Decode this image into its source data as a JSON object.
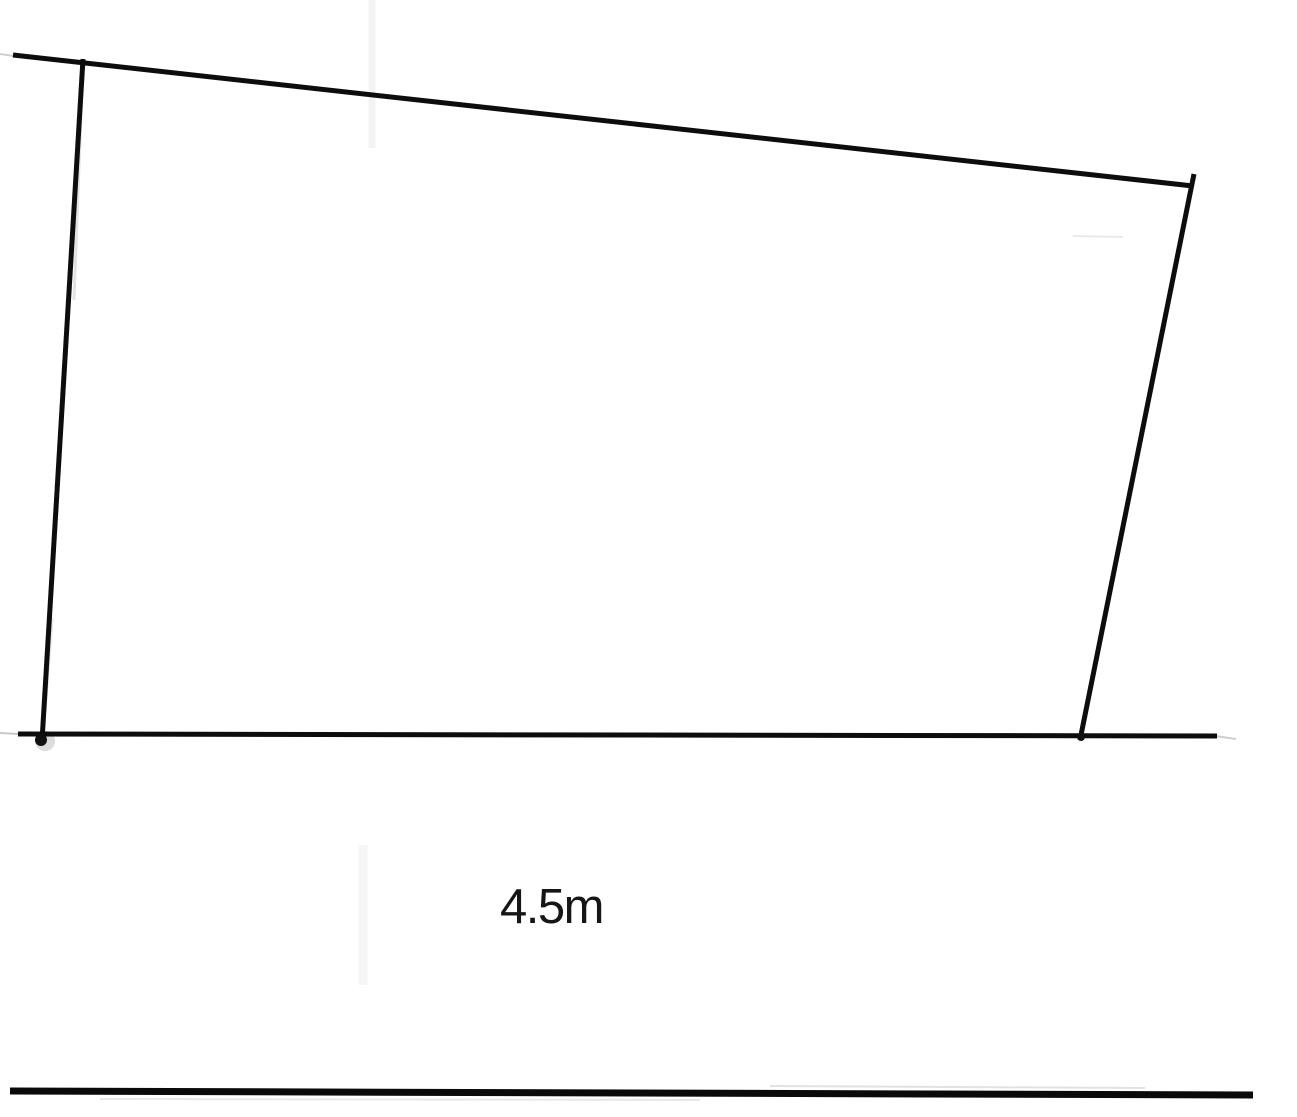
{
  "diagram": {
    "background_color": "#ffffff",
    "ink_color": "#0d0d0d",
    "label": {
      "text": "4.5m",
      "color": "#161616"
    },
    "shape": {
      "description": "hand-drawn quadrilateral (skewed rectangle) sitting on a ground line, scanned page with thick rule at page bottom",
      "vertices": [
        {
          "name": "top-left",
          "x": 83,
          "y": 63
        },
        {
          "name": "top-right",
          "x": 1191,
          "y": 185
        },
        {
          "name": "bottom-right",
          "x": 1080,
          "y": 737
        },
        {
          "name": "bottom-left",
          "x": 42,
          "y": 738
        }
      ]
    },
    "marks": [
      {
        "type": "dot",
        "name": "bottom-left-junction-halo",
        "cx": 45,
        "cy": 741,
        "r": 10,
        "color": "#dcdcdc"
      },
      {
        "type": "line",
        "name": "scan-artifact-vertical-top",
        "x1": 372,
        "y1": 0,
        "x2": 372,
        "y2": 148,
        "w": 7,
        "color": "#f3f3f3"
      },
      {
        "type": "line",
        "name": "scan-artifact-vertical-near-label",
        "x1": 363,
        "y1": 845,
        "x2": 363,
        "y2": 985,
        "w": 9,
        "color": "#f6f6f6"
      },
      {
        "type": "line",
        "name": "scan-artifact-horizontal-right",
        "x1": 1073,
        "y1": 236,
        "x2": 1123,
        "y2": 237,
        "w": 2,
        "color": "#e9e9e9"
      },
      {
        "type": "line",
        "name": "left-edge-ghost-upper",
        "x1": 82,
        "y1": 88,
        "x2": 74,
        "y2": 300,
        "w": 3,
        "color": "#e3e3e3"
      },
      {
        "type": "line",
        "name": "left-edge-ghost-lower",
        "x1": 52,
        "y1": 618,
        "x2": 45,
        "y2": 712,
        "w": 3,
        "color": "#e7e7e7"
      },
      {
        "type": "line",
        "name": "top-edge-lead-in",
        "x1": 0,
        "y1": 54,
        "x2": 14,
        "y2": 56,
        "w": 2,
        "color": "#cfcfcf"
      },
      {
        "type": "line",
        "name": "ground-line-lead-in",
        "x1": 0,
        "y1": 733,
        "x2": 18,
        "y2": 734,
        "w": 2,
        "color": "#c8c8c8"
      },
      {
        "type": "line",
        "name": "ground-line-tail",
        "x1": 1215,
        "y1": 736,
        "x2": 1236,
        "y2": 739,
        "w": 2,
        "color": "#cfcfcf"
      },
      {
        "type": "line",
        "name": "page-rule-noise-above",
        "x1": 770,
        "y1": 1086,
        "x2": 1145,
        "y2": 1088,
        "w": 2,
        "color": "#e2e2e2"
      },
      {
        "type": "line",
        "name": "page-rule-noise-below",
        "x1": 100,
        "y1": 1099,
        "x2": 700,
        "y2": 1100,
        "w": 2,
        "color": "#e8e8e8"
      },
      {
        "type": "line",
        "name": "top-edge",
        "x1": 13,
        "y1": 55,
        "x2": 1193,
        "y2": 186,
        "w": 5,
        "color": "#0d0d0d"
      },
      {
        "type": "line",
        "name": "left-edge",
        "x1": 83,
        "y1": 59,
        "x2": 42,
        "y2": 741,
        "w": 5,
        "color": "#0d0d0d"
      },
      {
        "type": "line",
        "name": "right-edge",
        "x1": 1194,
        "y1": 174,
        "x2": 1080,
        "y2": 740,
        "w": 5,
        "color": "#0d0d0d"
      },
      {
        "type": "line",
        "name": "ground-line",
        "x1": 18,
        "y1": 734,
        "x2": 1217,
        "y2": 736,
        "w": 5,
        "color": "#0d0d0d"
      },
      {
        "type": "dot",
        "name": "bottom-left-junction",
        "cx": 41,
        "cy": 740,
        "r": 6,
        "color": "#111111"
      },
      {
        "type": "dot",
        "name": "bottom-right-junction",
        "cx": 1081,
        "cy": 737,
        "r": 4,
        "color": "#111111"
      },
      {
        "type": "line",
        "name": "page-bottom-rule",
        "x1": 10,
        "y1": 1091,
        "x2": 1253,
        "y2": 1095,
        "w": 7,
        "color": "#0a0a0a"
      }
    ]
  }
}
